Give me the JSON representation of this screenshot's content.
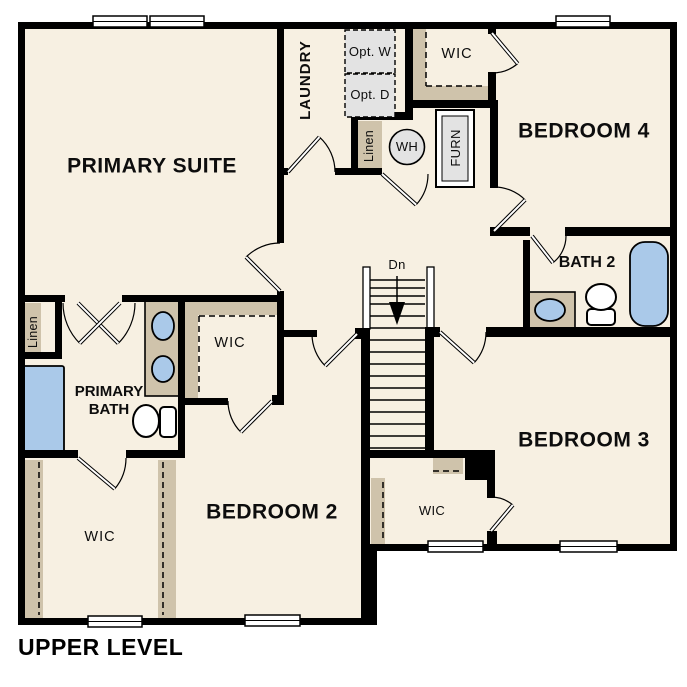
{
  "page_title": "UPPER LEVEL",
  "colors": {
    "background": "#ffffff",
    "floor": "#f7f0e2",
    "wall": "#000000",
    "cabinetry_tan": "#cfc3ab",
    "plumbing_blue": "#aac9e9",
    "appliance_gray": "#e3e3e3"
  },
  "rooms": {
    "primary_suite": {
      "label": "PRIMARY SUITE"
    },
    "laundry": {
      "label": "LAUNDRY"
    },
    "bedroom4": {
      "label": "BEDROOM 4"
    },
    "bedroom3": {
      "label": "BEDROOM 3"
    },
    "bedroom2": {
      "label": "BEDROOM 2"
    },
    "bath2": {
      "label": "BATH 2"
    },
    "primary_bath": {
      "label": "PRIMARY BATH"
    },
    "wic_bedroom4": {
      "label": "WIC"
    },
    "wic_bedroom2": {
      "label": "WIC"
    },
    "wic_primary": {
      "label": "WIC"
    },
    "wic_bedroom3": {
      "label": "WIC"
    }
  },
  "features": {
    "opt_washer": {
      "label": "Opt. W"
    },
    "opt_dryer": {
      "label": "Opt. D"
    },
    "water_heater": {
      "label": "WH"
    },
    "furnace": {
      "label": "FURN"
    },
    "linen_hall": {
      "label": "Linen"
    },
    "linen_primary": {
      "label": "Linen"
    },
    "stairs": {
      "label": "Dn"
    }
  }
}
